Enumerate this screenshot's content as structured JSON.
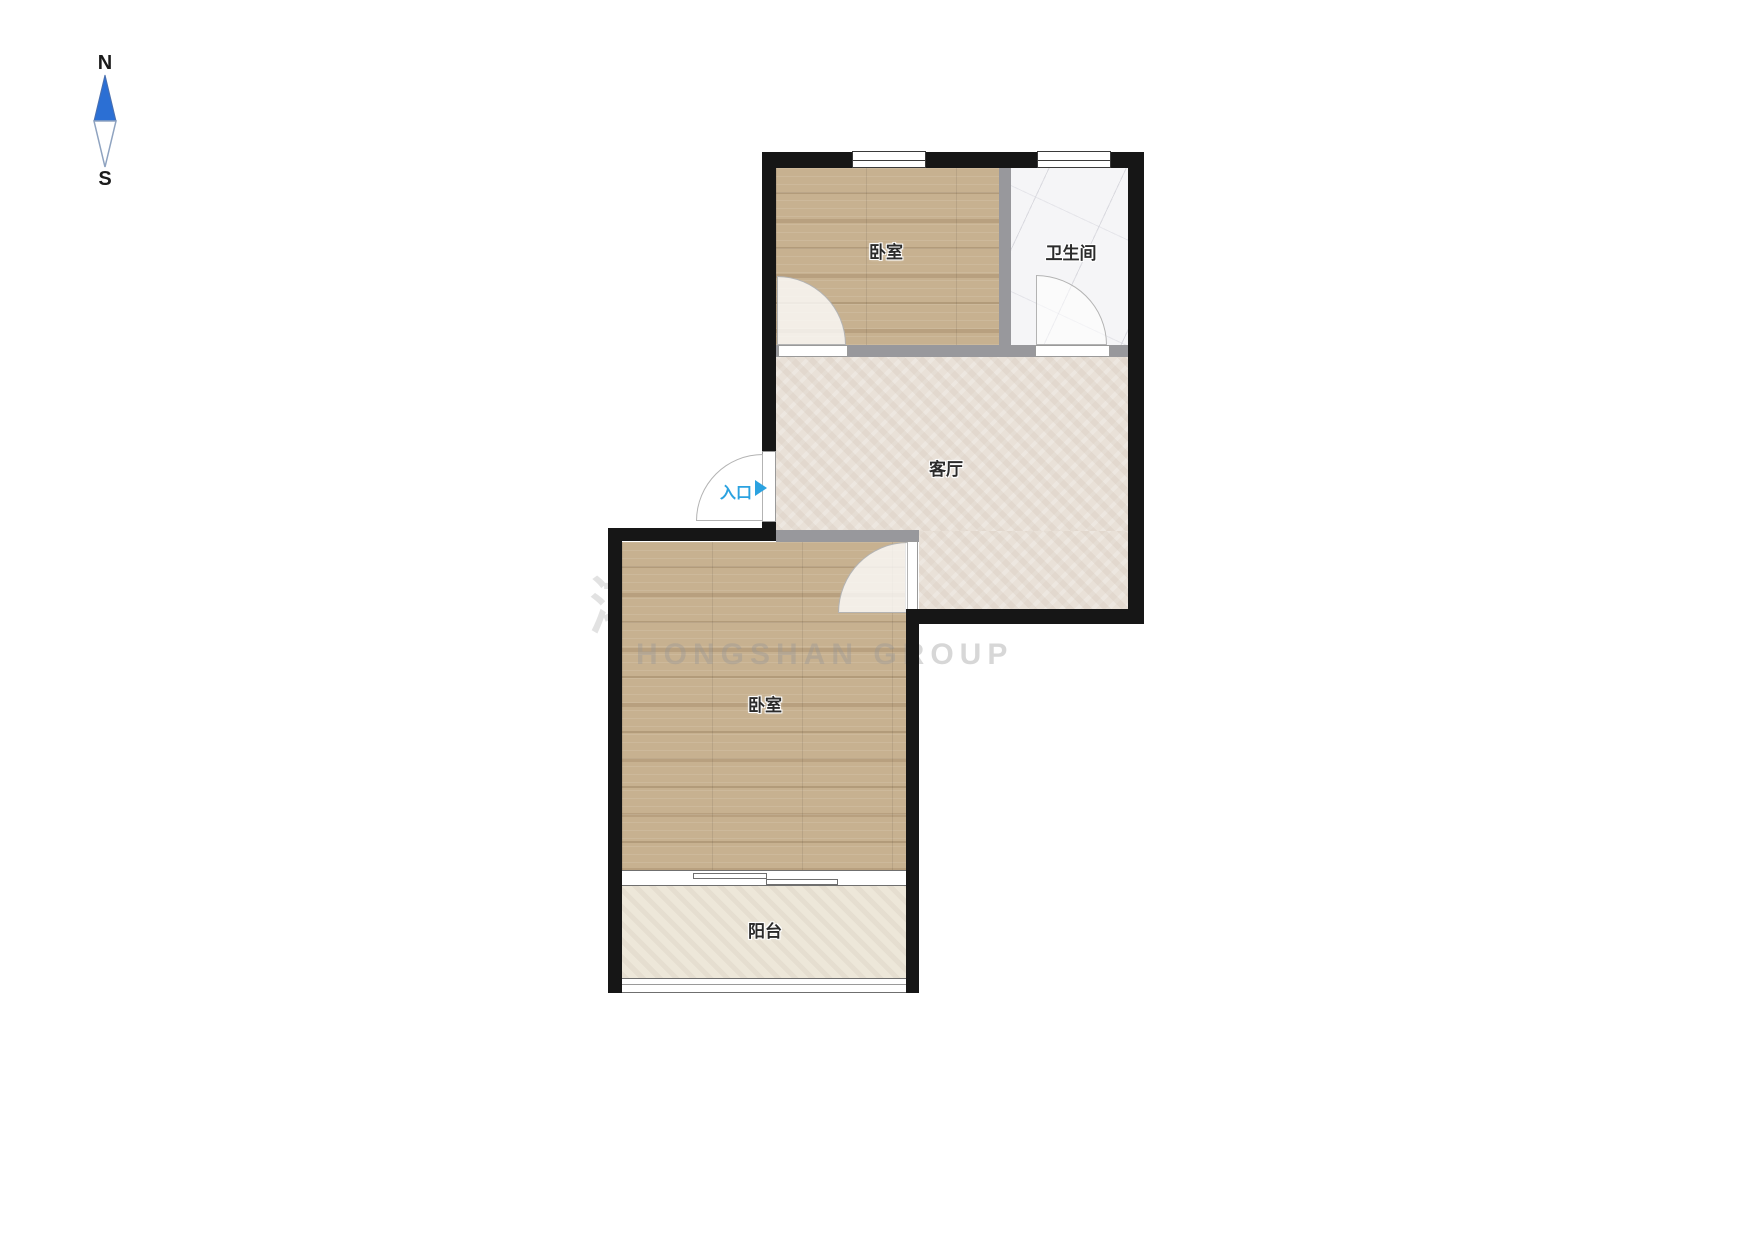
{
  "compass": {
    "north": "N",
    "south": "S"
  },
  "rooms": {
    "bedroom_upper": {
      "label": "卧室"
    },
    "bathroom": {
      "label": "卫生间"
    },
    "living_room": {
      "label": "客厅"
    },
    "bedroom_lower": {
      "label": "卧室"
    },
    "balcony": {
      "label": "阳台"
    }
  },
  "entrance": {
    "label": "入口"
  },
  "watermark": {
    "line1": "鸿山集团",
    "line2": "HONGSHAN GROUP"
  },
  "colors": {
    "wall": "#161616",
    "interior_wall": "#98989C",
    "wood_floor": "#C7B190",
    "living_floor": "#E9E1D8",
    "bathroom_floor": "#F5F5F7",
    "balcony_floor": "#EDE7D9",
    "entrance_accent": "#2BA2E0",
    "compass_north_fill": "#2B6FD4"
  }
}
